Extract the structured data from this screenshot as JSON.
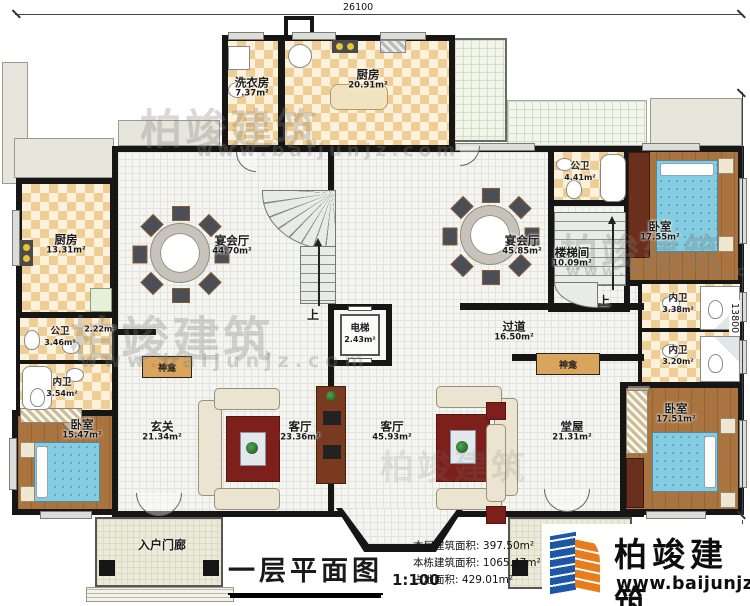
{
  "plan": {
    "dimensions": {
      "top": "26100",
      "right": "13800",
      "right_lower": "3000"
    },
    "stair_up_label": "上",
    "rooms": {
      "laundry": {
        "name": "洗衣房",
        "area": "7.37m²"
      },
      "kitchen_top": {
        "name": "厨房",
        "area": "20.91m²"
      },
      "kitchen_left": {
        "name": "厨房",
        "area": "13.31m²"
      },
      "public_bath_left": {
        "name": "公卫",
        "area": "3.46m²"
      },
      "closet_left": {
        "name": "",
        "area": "2.22m²"
      },
      "private_bath_left": {
        "name": "内卫",
        "area": "3.54m²"
      },
      "bedroom_left": {
        "name": "卧室",
        "area": "15.47m²"
      },
      "banquet_left": {
        "name": "宴会厅",
        "area": "44.70m²"
      },
      "banquet_right": {
        "name": "宴会厅",
        "area": "45.85m²"
      },
      "entry_hall": {
        "name": "玄关",
        "area": "21.34m²"
      },
      "living_left": {
        "name": "客厅",
        "area": "23.36m²"
      },
      "living_right": {
        "name": "客厅",
        "area": "45.93m²"
      },
      "elevator": {
        "name": "电梯",
        "area": "2.43m²"
      },
      "corridor": {
        "name": "过道",
        "area": "16.50m²"
      },
      "stair_hall": {
        "name": "楼梯间",
        "area": "10.09m²"
      },
      "public_bath_right": {
        "name": "公卫",
        "area": "4.41m²"
      },
      "bedroom_top_right": {
        "name": "卧室",
        "area": "17.55m²"
      },
      "private_bath_right_upper": {
        "name": "内卫",
        "area": "3.38m²"
      },
      "private_bath_right_lower": {
        "name": "内卫",
        "area": "3.20m²"
      },
      "bedroom_bottom_right": {
        "name": "卧室",
        "area": "17.51m²"
      },
      "main_hall": {
        "name": "堂屋",
        "area": "21.31m²"
      },
      "porch_left": {
        "name": "入户门廊"
      },
      "porch_right": {
        "name": "入户门廊"
      },
      "shrine_left": {
        "name": "神龛"
      },
      "shrine_right": {
        "name": "神龛"
      }
    }
  },
  "title_block": {
    "title": "一层平面图",
    "scale": "1:100",
    "stats": [
      {
        "label": "本层建筑面积:",
        "value": "397.50m²"
      },
      {
        "label": "本栋建筑面积:",
        "value": "1065.47m²"
      },
      {
        "label": "占地面积:",
        "value": "429.01m²"
      },
      {
        "label": "层高:",
        "value": "3.9m"
      }
    ]
  },
  "branding": {
    "company": "柏竣建筑",
    "website": "www.baijunjz.com"
  }
}
